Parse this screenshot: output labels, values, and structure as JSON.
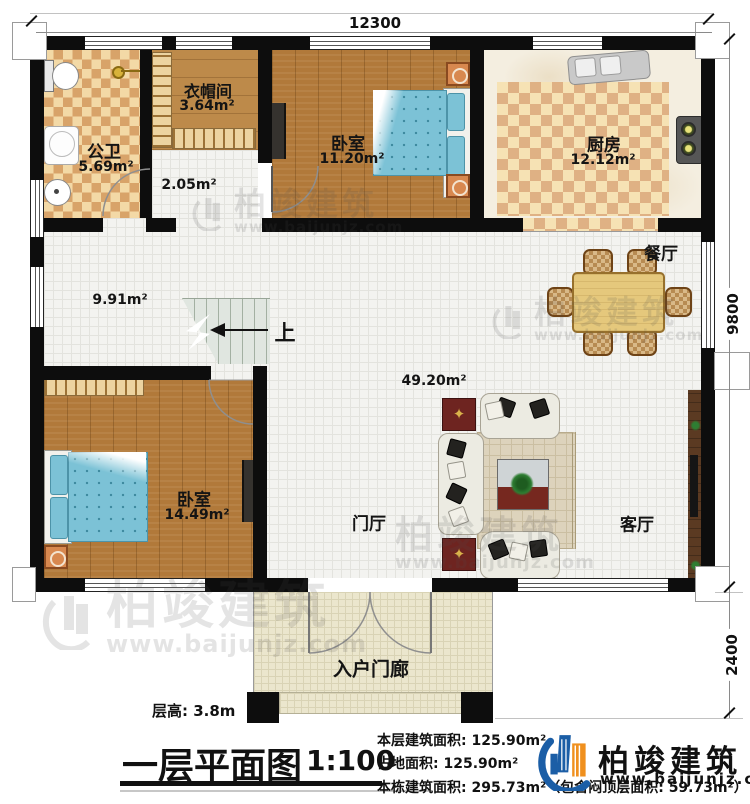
{
  "plan": {
    "dim_top": "12300",
    "dim_right_upper": "9800",
    "dim_right_lower": "2400",
    "rooms": {
      "bathroom": {
        "name": "公卫",
        "area": "5.69m²"
      },
      "cloakroom": {
        "name": "衣帽间",
        "area": "3.64m²"
      },
      "hall_small": {
        "area": "2.05m²"
      },
      "bedroom_top": {
        "name": "卧室",
        "area": "11.20m²"
      },
      "kitchen": {
        "name": "厨房",
        "area": "12.12m²"
      },
      "dining": {
        "name": "餐厅"
      },
      "hall": {
        "area": "9.91m²"
      },
      "great_room": {
        "area": "49.20m²"
      },
      "foyer": {
        "name": "门厅"
      },
      "bedroom_lower": {
        "name": "卧室",
        "area": "14.49m²"
      },
      "living": {
        "name": "客厅"
      },
      "porch": {
        "name": "入户门廊"
      }
    },
    "stairs_label": "上"
  },
  "watermark": {
    "brand": "柏竣建筑",
    "url": "www.baijunjz.com"
  },
  "footer": {
    "floor_height": "层高: 3.8m",
    "title": "一层平面图",
    "scale": "1:100",
    "stats": [
      "本层建筑面积: 125.90m²",
      "占地面积: 125.90m²",
      "本栋建筑面积: 295.73m²（包含闷顶层面积: 59.73m²）"
    ],
    "brand": "柏竣建筑",
    "brand_url": "www.baijunjz.com"
  },
  "colors": {
    "wall": "#0d0d0d",
    "accent_blue": "#1b5ea6",
    "accent_orange": "#f0901e"
  }
}
